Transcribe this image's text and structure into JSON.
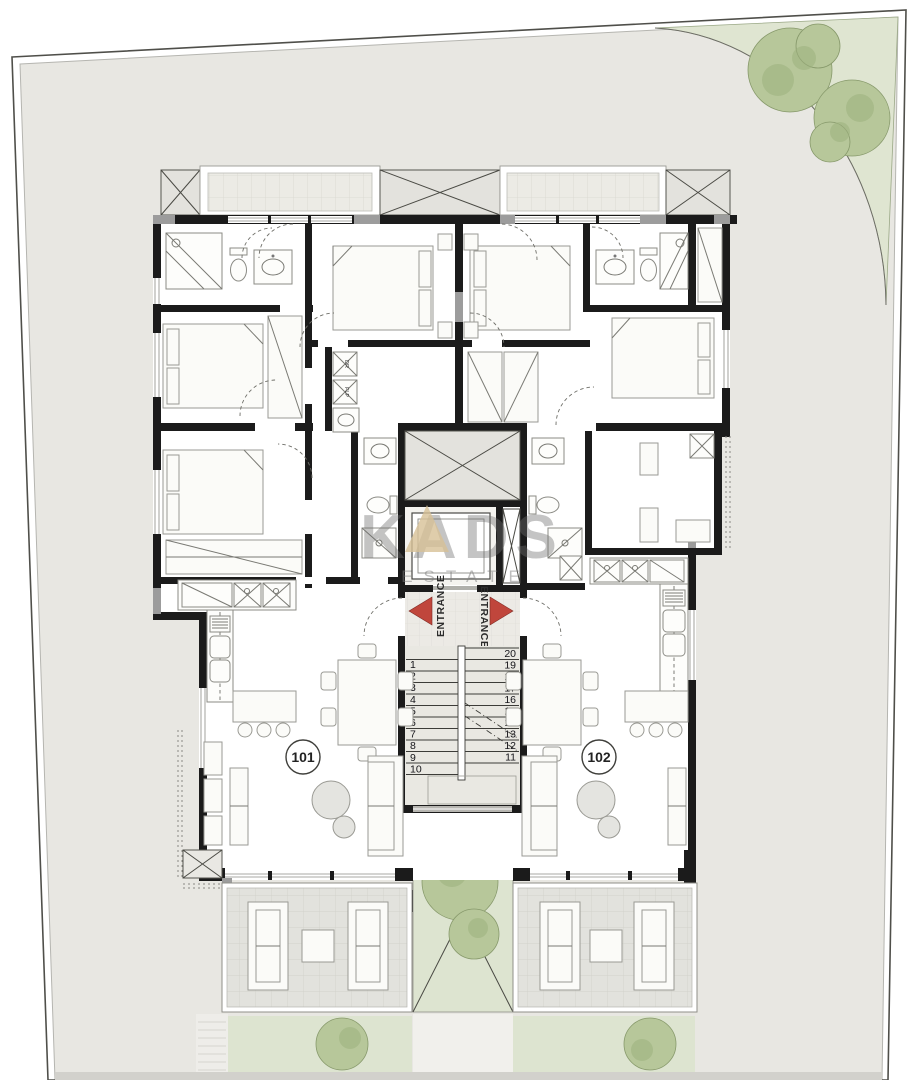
{
  "plan": {
    "watermark": {
      "brand": "KADS",
      "subtitle": "ESTATE",
      "triangle_color": "#d7c196"
    },
    "core": {
      "entrance_left_label": "ENTRANCE",
      "entrance_right_label": "ENTRANCE",
      "arrow_color": "#c0463c",
      "stair_numbers_left": [
        "1",
        "2",
        "3",
        "4",
        "5",
        "6",
        "7",
        "8",
        "9",
        "10"
      ],
      "stair_numbers_right": [
        "20",
        "19",
        "18",
        "17",
        "16",
        "15",
        "14",
        "13",
        "12",
        "11"
      ]
    },
    "units": [
      {
        "number": "101"
      },
      {
        "number": "102"
      }
    ],
    "laundry": {
      "dryer_label": "DR",
      "washer_label": "FLP"
    },
    "colors": {
      "site": "#e8e7e2",
      "wall": "#1b1b1b",
      "lawn": "#dde4d0",
      "tree": "#b7c79a",
      "balcony_tile": "#ecebe5",
      "slab": "#e3e2dd",
      "column_gray": "#9c9c9c",
      "arrow_red": "#c0463c",
      "watermark_tan": "#d7c196"
    }
  }
}
